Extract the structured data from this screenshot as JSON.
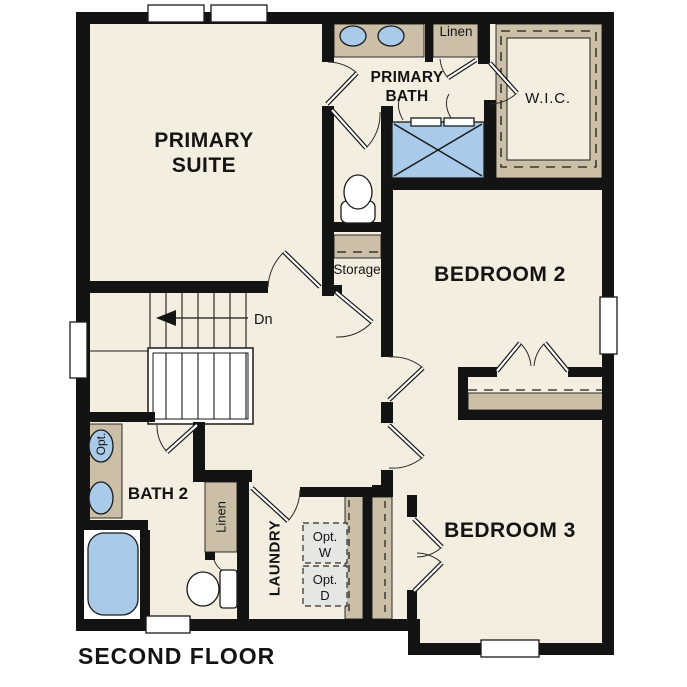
{
  "plan": {
    "title": "SECOND FLOOR",
    "rooms": {
      "primary_suite": {
        "line1": "PRIMARY",
        "line2": "SUITE"
      },
      "primary_bath": {
        "line1": "PRIMARY",
        "line2": "BATH"
      },
      "wic": {
        "label": "W.I.C."
      },
      "linen_upper": {
        "label": "Linen"
      },
      "storage": {
        "label": "Storage"
      },
      "bedroom2": {
        "label": "BEDROOM 2"
      },
      "bedroom3": {
        "label": "BEDROOM 3"
      },
      "bath2": {
        "label": "BATH 2"
      },
      "linen_lower": {
        "label": "Linen"
      },
      "laundry": {
        "label": "LAUNDRY"
      }
    },
    "stairs": {
      "label": "Dn"
    },
    "fixtures": {
      "optional_sink": {
        "label": "Opt."
      },
      "washer": {
        "line1": "Opt.",
        "line2": "W"
      },
      "dryer": {
        "line1": "Opt.",
        "line2": "D"
      }
    }
  },
  "colors": {
    "wall": "#131313",
    "floor": "#F4EEE1",
    "counter_tan": "#CBC0A7",
    "fixture_blue": "#A9CBE9",
    "appliance_gray": "#E4E7E2",
    "line": "#1A1A1A",
    "background": "#FFFFFF"
  }
}
